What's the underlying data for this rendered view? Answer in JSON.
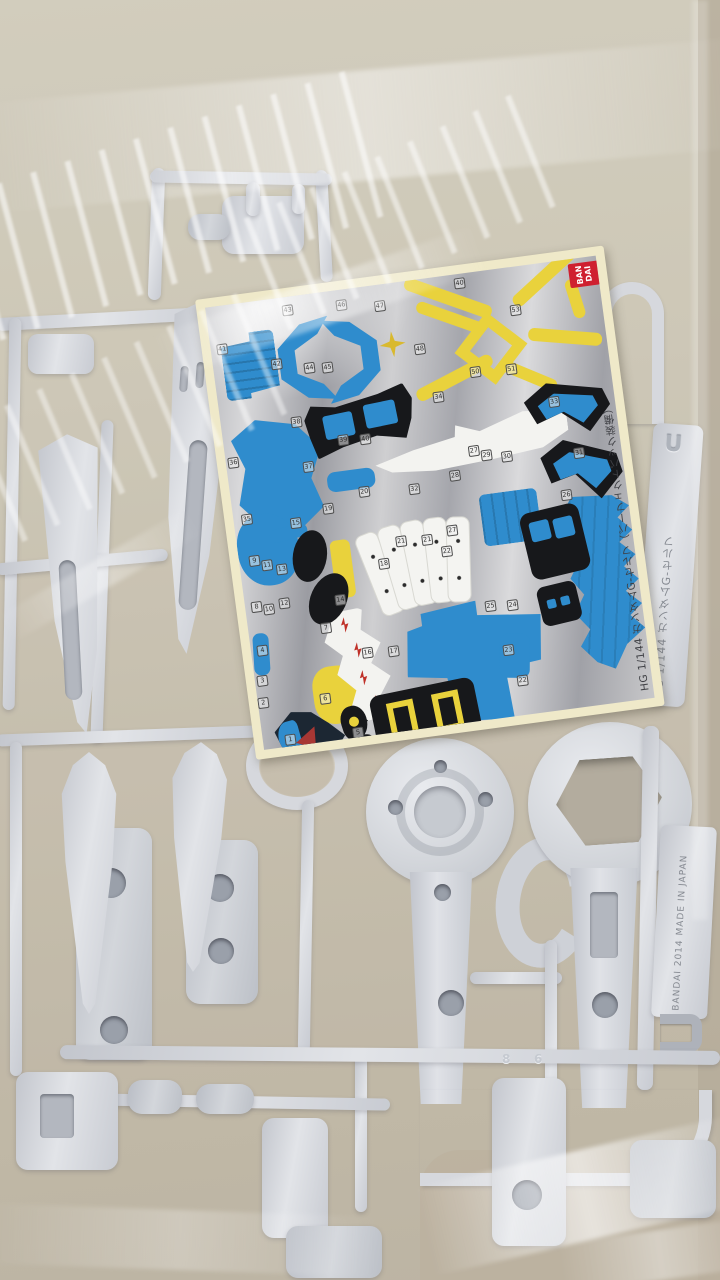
{
  "scene": {
    "description": "Clear plastic bag containing light-gray Gundam model kit runner frames and a silver foil marking sticker sheet"
  },
  "sticker_sheet": {
    "brand_lines": [
      "BAN",
      "DAI"
    ],
    "title_vertical": "HG 1/144 ガンダムG-セルフ（パーフェクトパック装備）",
    "part_numbers": [
      {
        "n": "41",
        "x": 6,
        "y": 38
      },
      {
        "n": "43",
        "x": 76,
        "y": 8
      },
      {
        "n": "42",
        "x": 58,
        "y": 60
      },
      {
        "n": "44",
        "x": 90,
        "y": 68
      },
      {
        "n": "45",
        "x": 108,
        "y": 70
      },
      {
        "n": "46",
        "x": 130,
        "y": 10
      },
      {
        "n": "47",
        "x": 168,
        "y": 16
      },
      {
        "n": "40",
        "x": 250,
        "y": 4
      },
      {
        "n": "48",
        "x": 202,
        "y": 64
      },
      {
        "n": "53",
        "x": 302,
        "y": 38
      },
      {
        "n": "50",
        "x": 254,
        "y": 94
      },
      {
        "n": "51",
        "x": 290,
        "y": 96
      },
      {
        "n": "34",
        "x": 214,
        "y": 114
      },
      {
        "n": "38",
        "x": 70,
        "y": 120
      },
      {
        "n": "39",
        "x": 114,
        "y": 144
      },
      {
        "n": "40",
        "x": 136,
        "y": 146
      },
      {
        "n": "36",
        "x": 2,
        "y": 152
      },
      {
        "n": "37",
        "x": 76,
        "y": 166
      },
      {
        "n": "33",
        "x": 328,
        "y": 134
      },
      {
        "n": "28",
        "x": 220,
        "y": 194
      },
      {
        "n": "32",
        "x": 178,
        "y": 202
      },
      {
        "n": "35",
        "x": 8,
        "y": 210
      },
      {
        "n": "15",
        "x": 56,
        "y": 220
      },
      {
        "n": "19",
        "x": 90,
        "y": 210
      },
      {
        "n": "20",
        "x": 128,
        "y": 198
      },
      {
        "n": "27",
        "x": 242,
        "y": 172
      },
      {
        "n": "29",
        "x": 254,
        "y": 178
      },
      {
        "n": "30",
        "x": 274,
        "y": 182
      },
      {
        "n": "31",
        "x": 346,
        "y": 188
      },
      {
        "n": "21",
        "x": 158,
        "y": 252
      },
      {
        "n": "21",
        "x": 184,
        "y": 254
      },
      {
        "n": "27",
        "x": 210,
        "y": 248
      },
      {
        "n": "26",
        "x": 328,
        "y": 228
      },
      {
        "n": "9",
        "x": 10,
        "y": 252
      },
      {
        "n": "11",
        "x": 22,
        "y": 258
      },
      {
        "n": "13",
        "x": 36,
        "y": 264
      },
      {
        "n": "18",
        "x": 138,
        "y": 272
      },
      {
        "n": "22",
        "x": 202,
        "y": 268
      },
      {
        "n": "8",
        "x": 6,
        "y": 298
      },
      {
        "n": "10",
        "x": 18,
        "y": 302
      },
      {
        "n": "12",
        "x": 34,
        "y": 298
      },
      {
        "n": "14",
        "x": 90,
        "y": 302
      },
      {
        "n": "7",
        "x": 72,
        "y": 328
      },
      {
        "n": "25",
        "x": 238,
        "y": 328
      },
      {
        "n": "24",
        "x": 260,
        "y": 330
      },
      {
        "n": "4",
        "x": 6,
        "y": 342
      },
      {
        "n": "16",
        "x": 110,
        "y": 358
      },
      {
        "n": "17",
        "x": 136,
        "y": 360
      },
      {
        "n": "3",
        "x": 2,
        "y": 372
      },
      {
        "n": "2",
        "x": 0,
        "y": 394
      },
      {
        "n": "6",
        "x": 62,
        "y": 398
      },
      {
        "n": "23",
        "x": 250,
        "y": 374
      },
      {
        "n": "22",
        "x": 260,
        "y": 406
      },
      {
        "n": "1",
        "x": 22,
        "y": 434
      },
      {
        "n": "5",
        "x": 90,
        "y": 436
      }
    ]
  },
  "runner": {
    "tag_letter": "U",
    "tag_model": "HG 1/144 ガンダムG-セルフ",
    "tag_maker": "BANDAI 2014 MADE IN JAPAN",
    "molded_digits": [
      "8",
      "6"
    ],
    "plastic_color": "#d6d8dd"
  },
  "colors": {
    "sticker_blue": "#2f8ccd",
    "sticker_yellow": "#e9d23c",
    "sticker_white": "#f3f3f0",
    "sticker_black": "#17181b",
    "logo_red": "#cf2030",
    "foil_silver": "#b9bac0",
    "sheet_border_cream": "#efe9c9",
    "table_tan": "#beb5a2"
  }
}
